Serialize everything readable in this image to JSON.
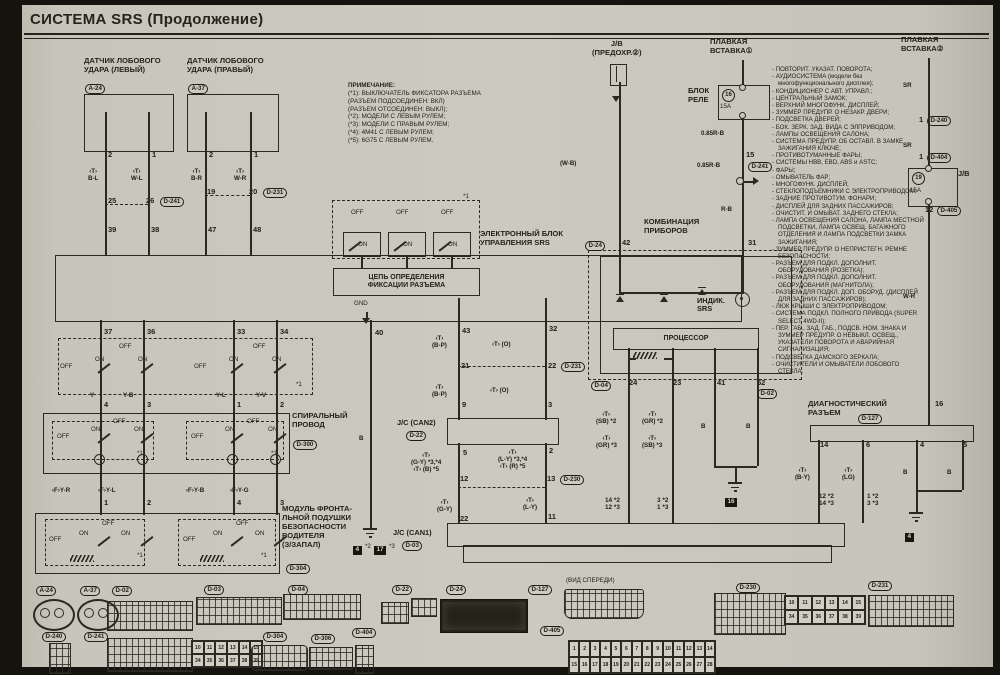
{
  "title": "СИСТЕМА SRS (Продолжение)",
  "note": {
    "heading": "ПРИМЕЧАНИЕ:",
    "lines": [
      "(*1): ВЫКЛЮЧАТЕЛЬ ФИКСАТОРА РАЗЪЕМА",
      "        (РАЗЪЕМ ПОДСОЕДИНЕН: ВКЛ)",
      "        (РАЗЪЕМ ОТСОЕДИНЕН: ВЫКЛ);",
      "(*2): МОДЕЛИ С ЛЕВЫМ РУЛЕМ;",
      "(*3): МОДЕЛИ С ПРАВЫМ РУЛЕМ;",
      "(*4): 4M41 С ЛЕВЫМ РУЛЕМ;",
      "(*5): 6G75 С ЛЕВЫМ РУЛЕМ."
    ]
  },
  "components": {
    "sensor_left": "ДАТЧИК ЛОБОВОГО\nУДАРА (ЛЕВЫЙ)",
    "sensor_right": "ДАТЧИК ЛОБОВОГО\nУДАРА (ПРАВЫЙ)",
    "jb_left": "J/B\n(ПРЕДОХР.②)",
    "fusible_link1": "ПЛАВКАЯ\nВСТАВКА①",
    "fusible_link2": "ПЛАВКАЯ\nВСТАВКА②",
    "relay_block": "БЛОК\nРЕЛЕ",
    "srs_ecu": "ЭЛЕКТРОННЫЙ БЛОК\nУПРАВЛЕНИЯ SRS",
    "lock_circuit": "ЦЕПЬ ОПРЕДЕЛЕНИЯ\nФИКСАЦИИ РАЗЪЕМА",
    "combo": "КОМБИНАЦИЯ\nПРИБОРОВ",
    "processor": "ПРОЦЕССОР",
    "spiral": "СПИРАЛЬНЫЙ\nПРОВОД",
    "airbag_module": "МОДУЛЬ ФРОНТА-\nЛЬНОЙ ПОДУШКИ\nБЕЗОПАСНОСТИ\nВОДИТЕЛЯ\n(З/ЗАПАЛ)",
    "diag": "ДИАГНОСТИЧЕСКИЙ\nРАЗЪЕМ"
  },
  "loads": [
    "ПОВТОРИТ. УКАЗАТ. ПОВОРОТА;",
    "АУДИОСИСТЕМА (модели без многофункционального дисплея);",
    "КОНДИЦИОНЕР С АВТ. УПРАВЛ.;",
    "ЦЕНТРАЛЬНЫЙ ЗАМОК;",
    "ВЕРХНИЙ МНОГОФУНК. ДИСПЛЕЙ;",
    "ЗУММЕР ПРЕДУПР. О НЕЗАКР. ДВЕРИ;",
    "ПОДСВЕТКА ДВЕРЕЙ;",
    "БОК. ЗЕРК. ЗАД. ВИДА С ЭЛПРИВОДОМ;",
    "ЛАМПЫ ОСВЕЩЕНИЯ САЛОНА;",
    "СИСТЕМА ПРЕДУПР. ОБ ОСТАВЛ. В ЗАМКЕ ЗАЖИГАНИЯ КЛЮЧЕ;",
    "ПРОТИВОТУМАННЫЕ ФАРЫ;",
    "СИСТЕМЫ HBB, EBD, ABS и ASTC;",
    "ФАРЫ;",
    "ОМЫВАТЕЛЬ ФАР;",
    "МНОГОФУНК. ДИСПЛЕЙ;",
    "СТЕКЛОПОДЪЕМНИКИ С ЭЛЕКТРОПРИВОДОМ;",
    "ЗАДНИЕ ПРОТИВОТУМ. ФОНАРИ;",
    "ДИСПЛЕЙ ДЛЯ ЗАДНИХ ПАССАЖИРОВ;",
    "ОЧИСТИТ. И ОМЫВАТ. ЗАДНЕГО СТЕКЛА;",
    "ЛАМПА ОСВЕЩЕНИЯ САЛОНА, ЛАМПА МЕСТНОЙ ПОДСВЕТКИ, ЛАМПА ОСВЕЩ. БАГАЖНОГО ОТДЕЛЕНИЯ И ЛАМПА ПОДСВЕТКИ ЗАМКА ЗАЖИГАНИЯ;",
    "ЗУММЕР ПРЕДУПР. О НЕПРИСТЕГН. РЕМНЕ БЕЗОПАСНОСТИ;",
    "РАЗЪЕМ ДЛЯ ПОДКЛ. ДОПОЛНИТ. ОБОРУДОВАНИЯ (РОЗЕТКА);",
    "РАЗЪЕМ ДЛЯ ПОДКЛ. ДОПОЛНИТ. ОБОРУДОВАНИЯ (МАГНИТОЛА);",
    "РАЗЪЕМ ДЛЯ ПОДКЛ. ДОП. ОБОРУД. (ДИСПЛЕЙ ДЛЯ ЗАДНИХ ПАССАЖИРОВ);",
    "ЛЮК КРЫШИ С ЭЛЕКТРОПРИВОДОМ;",
    "СИСТЕМА ПОДКЛ. ПОЛНОГО ПРИВОДА (SUPER SELECT 4WD-II);",
    "ПЕР. ГАБ., ЗАД. ГАБ., ПОДСВ. НОМ. ЗНАКА И ЗУММЕР ПРЕДУПР. О НЕВЫКЛ. ОСВЕЩ., УКАЗАТЕЛИ ПОВОРОТА И АВАРИЙНАЯ СИГНАЛИЗАЦИЯ;",
    "ПОДСВЕТКА ДАМСКОГО ЗЕРКАЛА;",
    "ОЧИСТИТЕЛИ И ОМЫВАТЕЛИ ЛОБОВОГО СТЕКЛА."
  ],
  "labels": [
    {
      "t": "2",
      "x": 108,
      "y": 151,
      "c": "p"
    },
    {
      "t": "1",
      "x": 152,
      "y": 151,
      "c": "p"
    },
    {
      "t": "2",
      "x": 209,
      "y": 151,
      "c": "p"
    },
    {
      "t": "1",
      "x": 254,
      "y": 151,
      "c": "p"
    },
    {
      "t": "‹T›\nB-L",
      "x": 88,
      "y": 168,
      "c": "w"
    },
    {
      "t": "‹T›\nW-L",
      "x": 131,
      "y": 168,
      "c": "w"
    },
    {
      "t": "‹T›\nB-R",
      "x": 191,
      "y": 168,
      "c": "w"
    },
    {
      "t": "‹T›\nW-R",
      "x": 234,
      "y": 168,
      "c": "w"
    },
    {
      "t": "25",
      "x": 108,
      "y": 197,
      "c": "p"
    },
    {
      "t": "26",
      "x": 146,
      "y": 197,
      "c": "p"
    },
    {
      "t": "D-241",
      "x": 160,
      "y": 197,
      "c": "bdg"
    },
    {
      "t": "19",
      "x": 207,
      "y": 188,
      "c": "p"
    },
    {
      "t": "20",
      "x": 249,
      "y": 188,
      "c": "p"
    },
    {
      "t": "D-231",
      "x": 263,
      "y": 188,
      "c": "bdg"
    },
    {
      "t": "39",
      "x": 108,
      "y": 226,
      "c": "p"
    },
    {
      "t": "38",
      "x": 151,
      "y": 226,
      "c": "p"
    },
    {
      "t": "47",
      "x": 208,
      "y": 226,
      "c": "p"
    },
    {
      "t": "48",
      "x": 253,
      "y": 226,
      "c": "p"
    },
    {
      "t": "*1",
      "x": 463,
      "y": 193,
      "c": "t"
    },
    {
      "t": "OFF",
      "x": 351,
      "y": 209,
      "c": "t"
    },
    {
      "t": "OFF",
      "x": 396,
      "y": 209,
      "c": "t"
    },
    {
      "t": "OFF",
      "x": 441,
      "y": 209,
      "c": "t"
    },
    {
      "t": "ON",
      "x": 358,
      "y": 241,
      "c": "t"
    },
    {
      "t": "ON",
      "x": 403,
      "y": 241,
      "c": "t"
    },
    {
      "t": "ON",
      "x": 448,
      "y": 241,
      "c": "t"
    },
    {
      "t": "GND",
      "x": 354,
      "y": 300,
      "c": "t"
    },
    {
      "t": "37",
      "x": 104,
      "y": 328,
      "c": "p"
    },
    {
      "t": "36",
      "x": 147,
      "y": 328,
      "c": "p"
    },
    {
      "t": "33",
      "x": 237,
      "y": 328,
      "c": "p"
    },
    {
      "t": "34",
      "x": 280,
      "y": 328,
      "c": "p"
    },
    {
      "t": "40",
      "x": 375,
      "y": 329,
      "c": "p"
    },
    {
      "t": "43",
      "x": 462,
      "y": 327,
      "c": "p"
    },
    {
      "t": "32",
      "x": 549,
      "y": 325,
      "c": "p"
    },
    {
      "t": "OFF",
      "x": 60,
      "y": 363,
      "c": "t"
    },
    {
      "t": "ON",
      "x": 95,
      "y": 356,
      "c": "t"
    },
    {
      "t": "OFF",
      "x": 119,
      "y": 343,
      "c": "t"
    },
    {
      "t": "ON",
      "x": 138,
      "y": 356,
      "c": "t"
    },
    {
      "t": "OFF",
      "x": 194,
      "y": 363,
      "c": "t"
    },
    {
      "t": "ON",
      "x": 229,
      "y": 356,
      "c": "t"
    },
    {
      "t": "OFF",
      "x": 253,
      "y": 343,
      "c": "t"
    },
    {
      "t": "ON",
      "x": 272,
      "y": 356,
      "c": "t"
    },
    {
      "t": "*1",
      "x": 296,
      "y": 381,
      "c": "t"
    },
    {
      "t": "Y",
      "x": 90,
      "y": 392,
      "c": "w"
    },
    {
      "t": "Y-B",
      "x": 123,
      "y": 392,
      "c": "w"
    },
    {
      "t": "Y-L",
      "x": 216,
      "y": 392,
      "c": "w"
    },
    {
      "t": "Y-V",
      "x": 256,
      "y": 392,
      "c": "w"
    },
    {
      "t": "4",
      "x": 104,
      "y": 401,
      "c": "p"
    },
    {
      "t": "3",
      "x": 147,
      "y": 401,
      "c": "p"
    },
    {
      "t": "1",
      "x": 237,
      "y": 401,
      "c": "p"
    },
    {
      "t": "2",
      "x": 280,
      "y": 401,
      "c": "p"
    },
    {
      "t": "OFF",
      "x": 57,
      "y": 433,
      "c": "t"
    },
    {
      "t": "ON",
      "x": 91,
      "y": 426,
      "c": "t"
    },
    {
      "t": "OFF",
      "x": 113,
      "y": 418,
      "c": "t"
    },
    {
      "t": "ON",
      "x": 134,
      "y": 426,
      "c": "t"
    },
    {
      "t": "OFF",
      "x": 191,
      "y": 433,
      "c": "t"
    },
    {
      "t": "ON",
      "x": 225,
      "y": 426,
      "c": "t"
    },
    {
      "t": "OFF",
      "x": 247,
      "y": 418,
      "c": "t"
    },
    {
      "t": "ON",
      "x": 268,
      "y": 426,
      "c": "t"
    },
    {
      "t": "*1",
      "x": 137,
      "y": 450,
      "c": "t"
    },
    {
      "t": "*1",
      "x": 271,
      "y": 450,
      "c": "t"
    },
    {
      "t": "‹F›Y-R",
      "x": 52,
      "y": 487,
      "c": "w"
    },
    {
      "t": "‹F›Y-L",
      "x": 98,
      "y": 487,
      "c": "w"
    },
    {
      "t": "‹F›Y-B",
      "x": 186,
      "y": 487,
      "c": "w"
    },
    {
      "t": "‹F›Y-G",
      "x": 230,
      "y": 487,
      "c": "w"
    },
    {
      "t": "1",
      "x": 104,
      "y": 499,
      "c": "p"
    },
    {
      "t": "2",
      "x": 147,
      "y": 499,
      "c": "p"
    },
    {
      "t": "4",
      "x": 237,
      "y": 499,
      "c": "p"
    },
    {
      "t": "3",
      "x": 280,
      "y": 499,
      "c": "p"
    },
    {
      "t": "OFF",
      "x": 49,
      "y": 536,
      "c": "t"
    },
    {
      "t": "ON",
      "x": 79,
      "y": 530,
      "c": "t"
    },
    {
      "t": "OFF",
      "x": 102,
      "y": 520,
      "c": "t"
    },
    {
      "t": "ON",
      "x": 121,
      "y": 530,
      "c": "t"
    },
    {
      "t": "OFF",
      "x": 183,
      "y": 536,
      "c": "t"
    },
    {
      "t": "ON",
      "x": 213,
      "y": 530,
      "c": "t"
    },
    {
      "t": "OFF",
      "x": 236,
      "y": 520,
      "c": "t"
    },
    {
      "t": "ON",
      "x": 255,
      "y": 530,
      "c": "t"
    },
    {
      "t": "*1",
      "x": 137,
      "y": 552,
      "c": "t"
    },
    {
      "t": "*1",
      "x": 261,
      "y": 552,
      "c": "t"
    },
    {
      "t": "B",
      "x": 359,
      "y": 435,
      "c": "w"
    },
    {
      "t": "‹T›\n(B-P)",
      "x": 432,
      "y": 335,
      "c": "w"
    },
    {
      "t": "‹T› (O)",
      "x": 492,
      "y": 341,
      "c": "w"
    },
    {
      "t": "21",
      "x": 461,
      "y": 362,
      "c": "p"
    },
    {
      "t": "22",
      "x": 548,
      "y": 362,
      "c": "p"
    },
    {
      "t": "D-231",
      "x": 561,
      "y": 362,
      "c": "bdg"
    },
    {
      "t": "‹T›\n(B-P)",
      "x": 432,
      "y": 384,
      "c": "w"
    },
    {
      "t": "‹T› (O)",
      "x": 490,
      "y": 387,
      "c": "w"
    },
    {
      "t": "9",
      "x": 462,
      "y": 401,
      "c": "p"
    },
    {
      "t": "3",
      "x": 548,
      "y": 401,
      "c": "p"
    },
    {
      "t": "J/C (CAN2)",
      "x": 397,
      "y": 419,
      "c": "b"
    },
    {
      "t": "D-22",
      "x": 406,
      "y": 431,
      "c": "bdg"
    },
    {
      "t": "5",
      "x": 463,
      "y": 449,
      "c": "p"
    },
    {
      "t": "2",
      "x": 549,
      "y": 447,
      "c": "p"
    },
    {
      "t": "‹T›\n(G-Y) *3,*4\n‹T› (B) *5",
      "x": 411,
      "y": 452,
      "c": "w"
    },
    {
      "t": "‹T›\n(L-Y) *3,*4\n‹T› (R) *5",
      "x": 498,
      "y": 449,
      "c": "w"
    },
    {
      "t": "12",
      "x": 460,
      "y": 475,
      "c": "p"
    },
    {
      "t": "13",
      "x": 547,
      "y": 475,
      "c": "p"
    },
    {
      "t": "D-230",
      "x": 560,
      "y": 475,
      "c": "bdg"
    },
    {
      "t": "‹T›\n(G-Y)",
      "x": 437,
      "y": 499,
      "c": "w"
    },
    {
      "t": "‹T›\n(L-Y)",
      "x": 523,
      "y": 497,
      "c": "w"
    },
    {
      "t": "22",
      "x": 460,
      "y": 515,
      "c": "p"
    },
    {
      "t": "11",
      "x": 548,
      "y": 513,
      "c": "p"
    },
    {
      "t": "J/C (CAN1)",
      "x": 393,
      "y": 529,
      "c": "b"
    },
    {
      "t": "D-03",
      "x": 402,
      "y": 541,
      "c": "bdg"
    },
    {
      "t": "4",
      "x": 353,
      "y": 546,
      "c": "gb"
    },
    {
      "t": "*2",
      "x": 365,
      "y": 543,
      "c": "t"
    },
    {
      "t": "17",
      "x": 374,
      "y": 546,
      "c": "gb"
    },
    {
      "t": "*3",
      "x": 389,
      "y": 543,
      "c": "t"
    },
    {
      "t": "(W-B)",
      "x": 560,
      "y": 160,
      "c": "w"
    },
    {
      "t": "0.85R-B",
      "x": 701,
      "y": 130,
      "c": "w"
    },
    {
      "t": "15",
      "x": 746,
      "y": 151,
      "c": "p"
    },
    {
      "t": "0.85R-B",
      "x": 697,
      "y": 162,
      "c": "w"
    },
    {
      "t": "D-241",
      "x": 748,
      "y": 162,
      "c": "bdg"
    },
    {
      "t": "R-B",
      "x": 721,
      "y": 206,
      "c": "w"
    },
    {
      "t": "SR",
      "x": 903,
      "y": 82,
      "c": "w"
    },
    {
      "t": "1",
      "x": 919,
      "y": 116,
      "c": "p"
    },
    {
      "t": "D-240",
      "x": 927,
      "y": 116,
      "c": "bdg"
    },
    {
      "t": "SR",
      "x": 903,
      "y": 142,
      "c": "w"
    },
    {
      "t": "1",
      "x": 919,
      "y": 153,
      "c": "p"
    },
    {
      "t": "D-404",
      "x": 927,
      "y": 153,
      "c": "bdg"
    },
    {
      "t": "J/B",
      "x": 958,
      "y": 170,
      "c": "b"
    },
    {
      "t": "12",
      "x": 925,
      "y": 206,
      "c": "p"
    },
    {
      "t": "D-405",
      "x": 937,
      "y": 206,
      "c": "bdg"
    },
    {
      "t": "W-R",
      "x": 903,
      "y": 293,
      "c": "w"
    },
    {
      "t": "16",
      "x": 935,
      "y": 400,
      "c": "p"
    },
    {
      "t": "42",
      "x": 622,
      "y": 239,
      "c": "p"
    },
    {
      "t": "31",
      "x": 748,
      "y": 239,
      "c": "p"
    },
    {
      "t": "ИНДИК.\nSRS",
      "x": 697,
      "y": 297,
      "c": "b"
    },
    {
      "t": "24",
      "x": 629,
      "y": 379,
      "c": "p"
    },
    {
      "t": "23",
      "x": 673,
      "y": 379,
      "c": "p"
    },
    {
      "t": "41",
      "x": 717,
      "y": 379,
      "c": "p"
    },
    {
      "t": "52",
      "x": 757,
      "y": 379,
      "c": "p"
    },
    {
      "t": "D-04",
      "x": 591,
      "y": 381,
      "c": "bdg"
    },
    {
      "t": "D-02",
      "x": 757,
      "y": 389,
      "c": "bdg"
    },
    {
      "t": "‹T›\n(SB) *2",
      "x": 596,
      "y": 411,
      "c": "w"
    },
    {
      "t": "‹T›\n(GR) *3",
      "x": 596,
      "y": 435,
      "c": "w"
    },
    {
      "t": "‹T›\n(GR) *2",
      "x": 642,
      "y": 411,
      "c": "w"
    },
    {
      "t": "‹T›\n(SB) *3",
      "x": 642,
      "y": 435,
      "c": "w"
    },
    {
      "t": "B",
      "x": 701,
      "y": 423,
      "c": "w"
    },
    {
      "t": "B",
      "x": 746,
      "y": 423,
      "c": "w"
    },
    {
      "t": "14 *2\n12 *3",
      "x": 605,
      "y": 497,
      "c": "p2"
    },
    {
      "t": "3 *2\n1 *3",
      "x": 657,
      "y": 497,
      "c": "p2"
    },
    {
      "t": "16",
      "x": 725,
      "y": 498,
      "c": "gb"
    },
    {
      "t": "14",
      "x": 820,
      "y": 441,
      "c": "p"
    },
    {
      "t": "6",
      "x": 866,
      "y": 441,
      "c": "p"
    },
    {
      "t": "4",
      "x": 920,
      "y": 441,
      "c": "p"
    },
    {
      "t": "5",
      "x": 963,
      "y": 441,
      "c": "p"
    },
    {
      "t": "‹T›\n(B-Y)",
      "x": 795,
      "y": 467,
      "c": "w"
    },
    {
      "t": "‹T›\n(LG)",
      "x": 842,
      "y": 467,
      "c": "w"
    },
    {
      "t": "B",
      "x": 903,
      "y": 469,
      "c": "w"
    },
    {
      "t": "B",
      "x": 947,
      "y": 469,
      "c": "w"
    },
    {
      "t": "12 *2\n14 *3",
      "x": 819,
      "y": 493,
      "c": "p2"
    },
    {
      "t": "1 *2\n3 *3",
      "x": 867,
      "y": 493,
      "c": "p2"
    },
    {
      "t": "4",
      "x": 905,
      "y": 533,
      "c": "gb"
    },
    {
      "t": "A-24",
      "x": 85,
      "y": 84,
      "c": "bdg"
    },
    {
      "t": "A-37",
      "x": 188,
      "y": 84,
      "c": "bdg"
    },
    {
      "t": "D-24",
      "x": 585,
      "y": 241,
      "c": "bdg"
    },
    {
      "t": "D-300",
      "x": 293,
      "y": 440,
      "c": "bdg"
    },
    {
      "t": "D-304",
      "x": 286,
      "y": 564,
      "c": "bdg"
    },
    {
      "t": "D-127",
      "x": 858,
      "y": 414,
      "c": "bdg"
    },
    {
      "t": "16",
      "x": 722,
      "y": 89,
      "c": "circ"
    },
    {
      "t": "15A",
      "x": 720,
      "y": 103,
      "c": "t"
    },
    {
      "t": "19",
      "x": 912,
      "y": 172,
      "c": "circ"
    },
    {
      "t": "15A",
      "x": 910,
      "y": 187,
      "c": "t"
    },
    {
      "t": "A-24",
      "x": 36,
      "y": 586,
      "c": "bdg"
    },
    {
      "t": "A-37",
      "x": 80,
      "y": 586,
      "c": "bdg"
    },
    {
      "t": "D-02",
      "x": 112,
      "y": 586,
      "c": "bdg"
    },
    {
      "t": "D-03",
      "x": 204,
      "y": 585,
      "c": "bdg"
    },
    {
      "t": "D-04",
      "x": 288,
      "y": 585,
      "c": "bdg"
    },
    {
      "t": "D-22",
      "x": 392,
      "y": 585,
      "c": "bdg"
    },
    {
      "t": "D-24",
      "x": 446,
      "y": 585,
      "c": "bdg"
    },
    {
      "t": "(ВИД СПЕРЕДИ)",
      "x": 566,
      "y": 577,
      "c": "t"
    },
    {
      "t": "D-127",
      "x": 528,
      "y": 585,
      "c": "bdg"
    },
    {
      "t": "D-230",
      "x": 736,
      "y": 583,
      "c": "bdg"
    },
    {
      "t": "D-231",
      "x": 868,
      "y": 581,
      "c": "bdg"
    },
    {
      "t": "D-240",
      "x": 42,
      "y": 632,
      "c": "bdg"
    },
    {
      "t": "D-241",
      "x": 84,
      "y": 632,
      "c": "bdg"
    },
    {
      "t": "D-304",
      "x": 263,
      "y": 632,
      "c": "bdg"
    },
    {
      "t": "D-306",
      "x": 311,
      "y": 634,
      "c": "bdg"
    },
    {
      "t": "D-404",
      "x": 352,
      "y": 628,
      "c": "bdg"
    },
    {
      "t": "D-405",
      "x": 540,
      "y": 626,
      "c": "bdg"
    }
  ],
  "bottom": {
    "d405_rows": [
      [
        "1",
        "2",
        "3",
        "4",
        "5",
        "6",
        "7",
        "8",
        "9",
        "10",
        "11",
        "12",
        "13",
        "14"
      ],
      [
        "15",
        "16",
        "17",
        "18",
        "19",
        "20",
        "21",
        "22",
        "23",
        "24",
        "25",
        "26",
        "27",
        "28"
      ]
    ],
    "d230_rows": [
      [
        "10",
        "11",
        "12",
        "13",
        "14",
        "15"
      ],
      [
        "34",
        "35",
        "36",
        "37",
        "38",
        "39"
      ]
    ],
    "d241_rows": [
      [
        "10",
        "11",
        "12",
        "13",
        "14",
        "15"
      ],
      [
        "34",
        "35",
        "36",
        "37",
        "38",
        "39"
      ]
    ]
  }
}
